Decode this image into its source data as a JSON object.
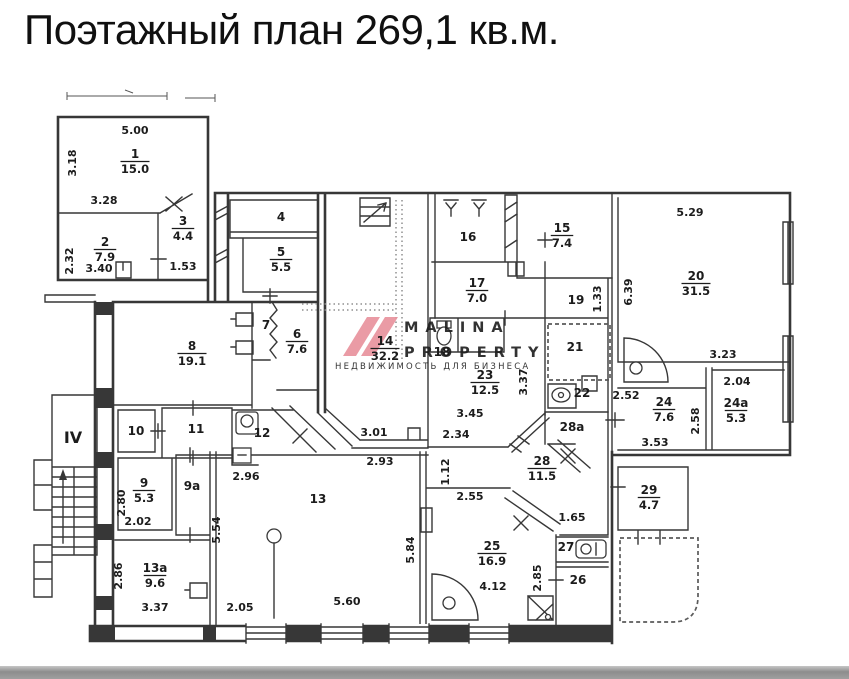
{
  "title": "Поэтажный план 269,1 кв.м.",
  "watermark": {
    "line1": "MALINA",
    "line2": "PROPERTY",
    "line3": "НЕДВИЖИМОСТЬ ДЛЯ БИЗНЕСА",
    "logo_color": "#e8919c",
    "text_color": "#8f8f8f",
    "sub_color": "#b5b5b5"
  },
  "plan": {
    "ink_color": "#373737",
    "rooms": [
      {
        "n": "1",
        "a": "15.0",
        "x": 135,
        "y": 158
      },
      {
        "n": "2",
        "a": "7.9",
        "x": 105,
        "y": 246
      },
      {
        "n": "3",
        "a": "4.4",
        "x": 183,
        "y": 225
      },
      {
        "n": "4",
        "x": 281,
        "y": 221
      },
      {
        "n": "5",
        "a": "5.5",
        "x": 281,
        "y": 256
      },
      {
        "n": "6",
        "a": "7.6",
        "x": 297,
        "y": 338
      },
      {
        "n": "7",
        "x": 266,
        "y": 329
      },
      {
        "n": "8",
        "a": "19.1",
        "x": 192,
        "y": 350
      },
      {
        "n": "9",
        "a": "5.3",
        "x": 144,
        "y": 487
      },
      {
        "n": "9а",
        "x": 192,
        "y": 490
      },
      {
        "n": "10",
        "x": 136,
        "y": 435
      },
      {
        "n": "11",
        "x": 196,
        "y": 433
      },
      {
        "n": "12",
        "x": 262,
        "y": 437
      },
      {
        "n": "13",
        "x": 318,
        "y": 503
      },
      {
        "n": "13а",
        "a": "9.6",
        "x": 155,
        "y": 572
      },
      {
        "n": "14",
        "a": "32.2",
        "x": 385,
        "y": 345
      },
      {
        "n": "15",
        "a": "7.4",
        "x": 562,
        "y": 232
      },
      {
        "n": "16",
        "x": 468,
        "y": 241
      },
      {
        "n": "17",
        "a": "7.0",
        "x": 477,
        "y": 287
      },
      {
        "n": "18",
        "x": 442,
        "y": 356
      },
      {
        "n": "19",
        "x": 576,
        "y": 304
      },
      {
        "n": "20",
        "a": "31.5",
        "x": 696,
        "y": 280
      },
      {
        "n": "21",
        "x": 575,
        "y": 351
      },
      {
        "n": "22",
        "x": 582,
        "y": 397
      },
      {
        "n": "23",
        "a": "12.5",
        "x": 485,
        "y": 379
      },
      {
        "n": "24",
        "a": "7.6",
        "x": 664,
        "y": 406
      },
      {
        "n": "24а",
        "a": "5.3",
        "x": 736,
        "y": 407
      },
      {
        "n": "25",
        "a": "16.9",
        "x": 492,
        "y": 550
      },
      {
        "n": "26",
        "x": 578,
        "y": 584
      },
      {
        "n": "27",
        "x": 566,
        "y": 551
      },
      {
        "n": "28",
        "a": "11.5",
        "x": 542,
        "y": 465
      },
      {
        "n": "28а",
        "x": 572,
        "y": 431
      },
      {
        "n": "29",
        "a": "4.7",
        "x": 649,
        "y": 494
      },
      {
        "n": "IV",
        "x": 73,
        "y": 443,
        "big": true
      }
    ],
    "dims": [
      {
        "t": "5.00",
        "x": 135,
        "y": 134
      },
      {
        "t": "3.18",
        "x": 76,
        "y": 163,
        "r": -90
      },
      {
        "t": "3.28",
        "x": 104,
        "y": 204
      },
      {
        "t": "2.32",
        "x": 73,
        "y": 261,
        "r": -90
      },
      {
        "t": "3.40",
        "x": 99,
        "y": 272
      },
      {
        "t": "1.53",
        "x": 183,
        "y": 270
      },
      {
        "t": "5.29",
        "x": 690,
        "y": 216
      },
      {
        "t": "6.39",
        "x": 632,
        "y": 292,
        "r": -90
      },
      {
        "t": "1.33",
        "x": 601,
        "y": 299,
        "r": -90
      },
      {
        "t": "3.37",
        "x": 527,
        "y": 382,
        "r": -90
      },
      {
        "t": "3.45",
        "x": 470,
        "y": 417
      },
      {
        "t": "2.34",
        "x": 456,
        "y": 438
      },
      {
        "t": "3.01",
        "x": 374,
        "y": 436
      },
      {
        "t": "2.93",
        "x": 380,
        "y": 465
      },
      {
        "t": "1.12",
        "x": 449,
        "y": 472,
        "r": -90
      },
      {
        "t": "2.96",
        "x": 246,
        "y": 480
      },
      {
        "t": "5.54",
        "x": 220,
        "y": 530,
        "r": -90
      },
      {
        "t": "2.80",
        "x": 125,
        "y": 503,
        "r": -90
      },
      {
        "t": "2.02",
        "x": 138,
        "y": 525
      },
      {
        "t": "2.86",
        "x": 122,
        "y": 576,
        "r": -90
      },
      {
        "t": "3.37",
        "x": 155,
        "y": 611
      },
      {
        "t": "2.05",
        "x": 240,
        "y": 611
      },
      {
        "t": "5.60",
        "x": 347,
        "y": 605
      },
      {
        "t": "5.84",
        "x": 414,
        "y": 550,
        "r": -90
      },
      {
        "t": "2.55",
        "x": 470,
        "y": 500
      },
      {
        "t": "4.12",
        "x": 493,
        "y": 590
      },
      {
        "t": "1.65",
        "x": 572,
        "y": 521
      },
      {
        "t": "2.85",
        "x": 541,
        "y": 578,
        "r": -90
      },
      {
        "t": "2.52",
        "x": 626,
        "y": 399
      },
      {
        "t": "3.53",
        "x": 655,
        "y": 446
      },
      {
        "t": "2.58",
        "x": 699,
        "y": 421,
        "r": -90
      },
      {
        "t": "2.04",
        "x": 737,
        "y": 385
      },
      {
        "t": "3.23",
        "x": 723,
        "y": 358
      }
    ]
  }
}
